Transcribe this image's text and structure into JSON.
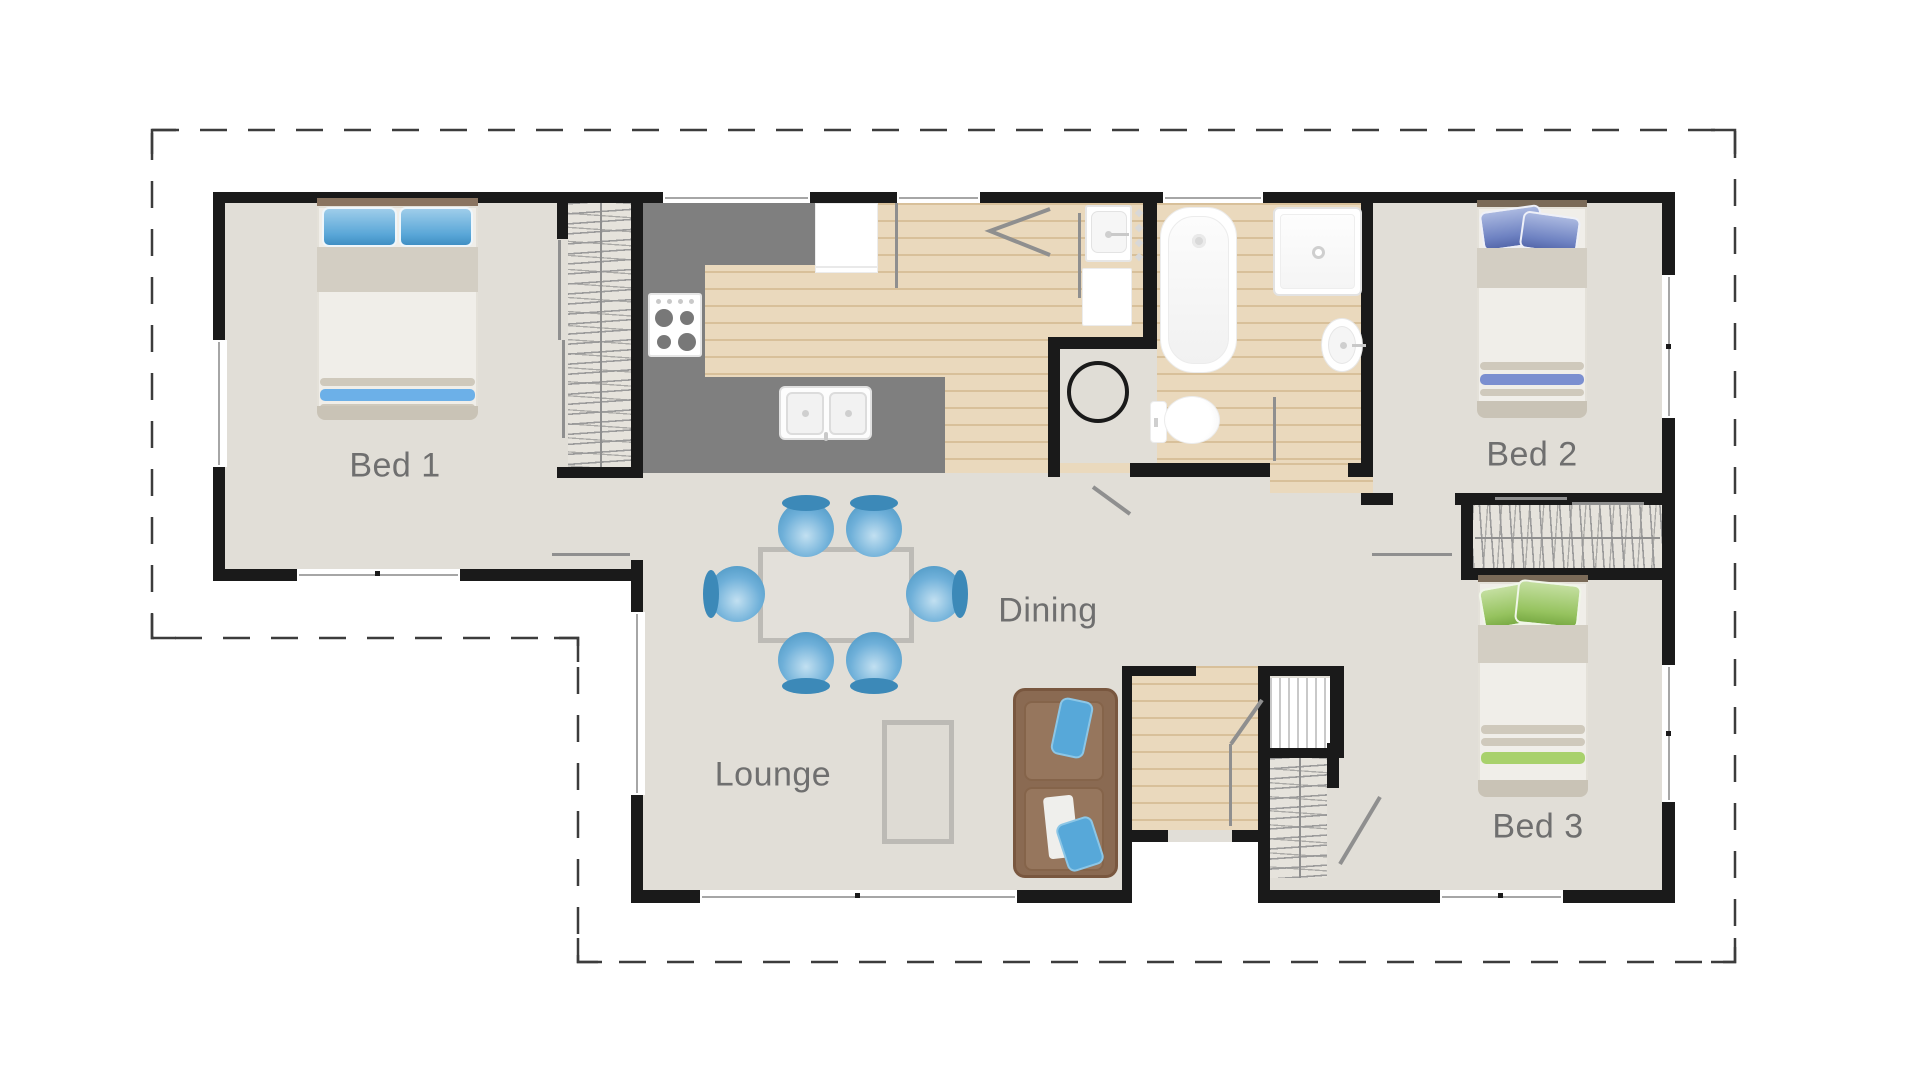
{
  "plan": {
    "type": "residential-floor-plan",
    "rooms": [
      {
        "id": "bed1",
        "label": "Bed 1"
      },
      {
        "id": "bed2",
        "label": "Bed 2"
      },
      {
        "id": "bed3",
        "label": "Bed 3"
      },
      {
        "id": "dining",
        "label": "Dining"
      },
      {
        "id": "lounge",
        "label": "Lounge"
      }
    ],
    "fixtures": {
      "bed1": [
        "double-bed",
        "wardrobe"
      ],
      "bed2": [
        "single-bed"
      ],
      "bed3": [
        "single-bed",
        "wardrobe"
      ],
      "kitchen": [
        "stove",
        "fridge",
        "double-sink",
        "island-bench"
      ],
      "bathroom": [
        "bathtub",
        "shower",
        "toilet",
        "basin"
      ],
      "laundry": [
        "laundry-tub",
        "washing-machine",
        "hot-water-cylinder"
      ],
      "living": [
        "dining-table",
        "dining-chairs-x6",
        "sofa",
        "rug"
      ],
      "entry": [
        "front-door",
        "porch-step",
        "hall-cupboard"
      ]
    },
    "colors": {
      "wall": "#1a1a1a",
      "floor": "#e1ded7",
      "timber_floor": "#ead9bd",
      "kitchen_bench": "#7f7f7f",
      "label_text": "#6f6f6f",
      "accent_blue": "#5fa8d8",
      "accent_indigo": "#6e82c2",
      "accent_green": "#96c35f",
      "sofa_brown": "#8a6a52",
      "boundary_dash": "#3c3c3c"
    }
  }
}
